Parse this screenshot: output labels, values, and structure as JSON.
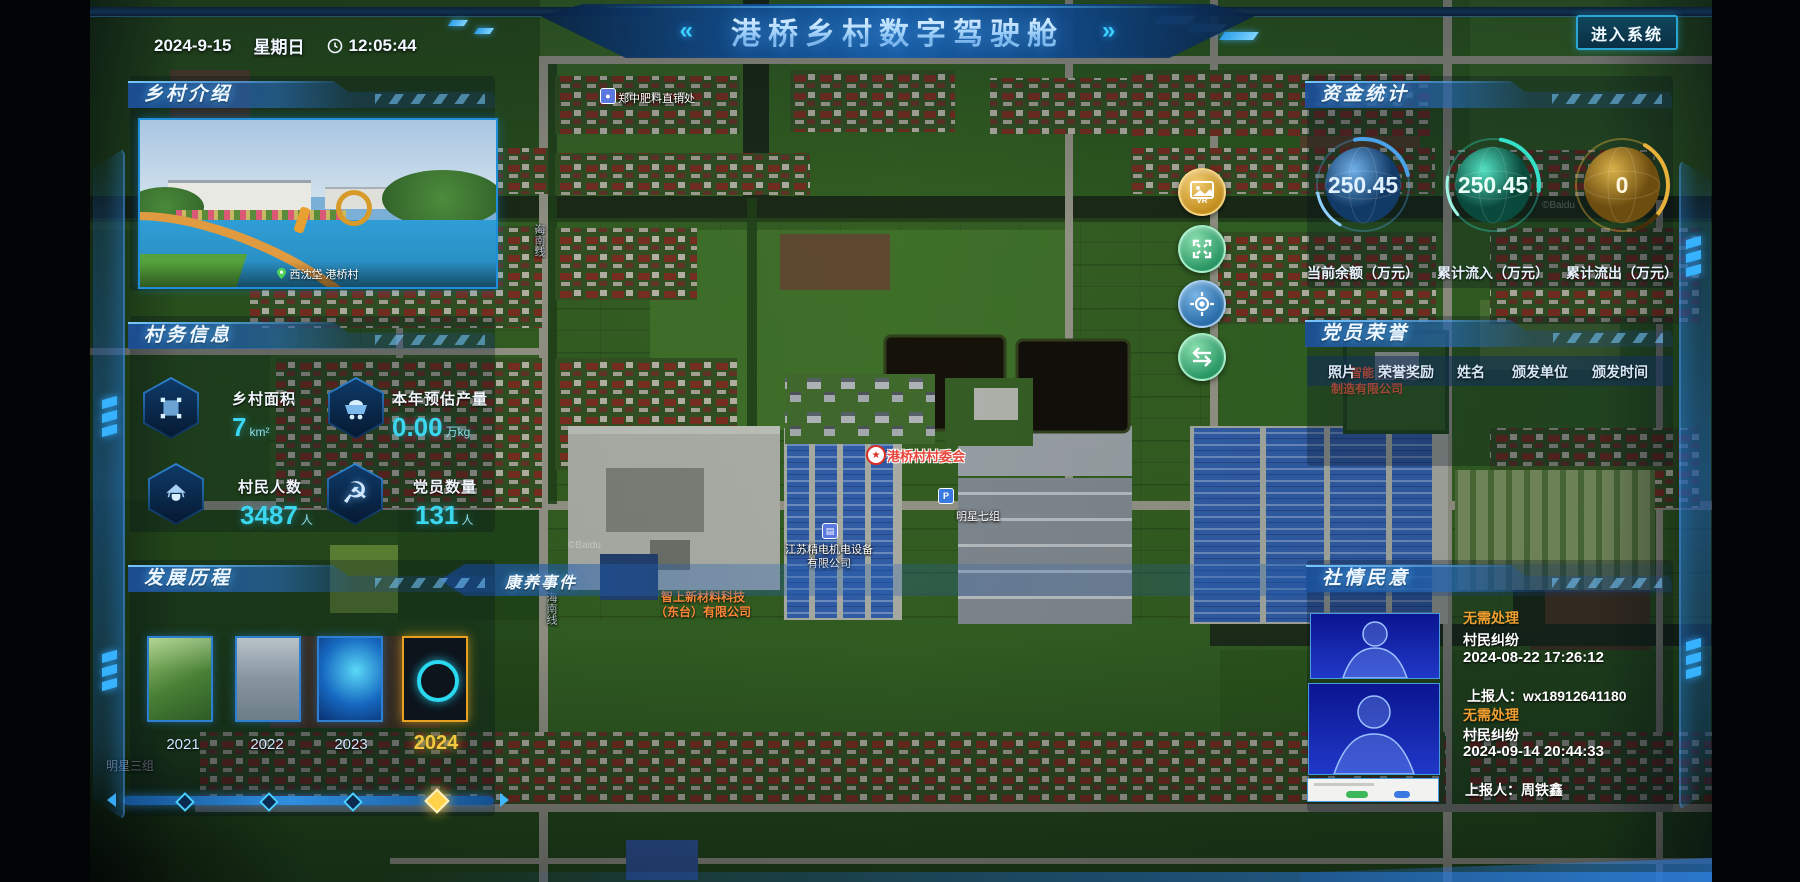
{
  "header": {
    "date": "2024-9-15",
    "weekday": "星期日",
    "time": "12:05:44",
    "title": "港桥乡村数字驾驶舱",
    "chevron_left": "«",
    "chevron_right": "»",
    "enter_button": "进入系统"
  },
  "intro": {
    "title": "乡村介绍",
    "caption": "西沈垈 港桥村"
  },
  "info": {
    "title": "村务信息",
    "stats": [
      {
        "label": "乡村面积",
        "value": "7",
        "unit": "km²"
      },
      {
        "label": "本年预估产量",
        "value": "0.00",
        "unit": "万kg"
      },
      {
        "label": "村民人数",
        "value": "3487",
        "unit": "人"
      },
      {
        "label": "党员数量",
        "value": "131",
        "unit": "人"
      }
    ]
  },
  "development": {
    "title": "发展历程",
    "years": [
      "2021",
      "2022",
      "2023",
      "2024"
    ],
    "active_year": "2024"
  },
  "funds": {
    "title": "资金统计",
    "gauges": [
      {
        "value": "250.45",
        "label": "当前余额（万元）",
        "color": "#4aa3e8"
      },
      {
        "value": "250.45",
        "label": "累计流入（万元）",
        "color": "#35e0c8"
      },
      {
        "value": "0",
        "label": "累计流出（万元）",
        "color": "#e8b23a"
      }
    ]
  },
  "honor": {
    "title": "党员荣誉",
    "columns": [
      "照片",
      "荣誉奖励",
      "姓名",
      "颁发单位",
      "颁发时间"
    ]
  },
  "sentiment": {
    "title": "社情民意",
    "items": [
      {
        "status": "无需处理",
        "type": "村民纠纷",
        "datetime": "2024-08-22 17:26:12",
        "reporter": "上报人：wx18912641180"
      },
      {
        "status": "无需处理",
        "type": "村民纠纷",
        "datetime": "2024-09-14 20:44:33",
        "reporter": "上报人：周铁鑫"
      }
    ]
  },
  "events": {
    "health_label": "康养事件"
  },
  "map": {
    "vr_label": "VR",
    "parking": "P",
    "star": "★",
    "watermark": "©Baidu",
    "labels": {
      "fertilizer": "郑中肥料直销处",
      "committee": "港桥村村委会",
      "factory1_line1": "江苏精电机电设备",
      "factory1_line2": "有限公司",
      "factory2_line1": "智上新材料科技",
      "factory2_line2": "（东台）有限公司",
      "group7": "明星七组",
      "group3": "明星三组",
      "road": "海南线",
      "mfg_faint1": "智能",
      "mfg_faint2": "制造有限公司"
    }
  },
  "icons": {
    "party": "☭"
  },
  "colors": {
    "accent": "#2ea8ff",
    "status_orange": "#f0a030",
    "highlight_gold": "#f5c842"
  }
}
